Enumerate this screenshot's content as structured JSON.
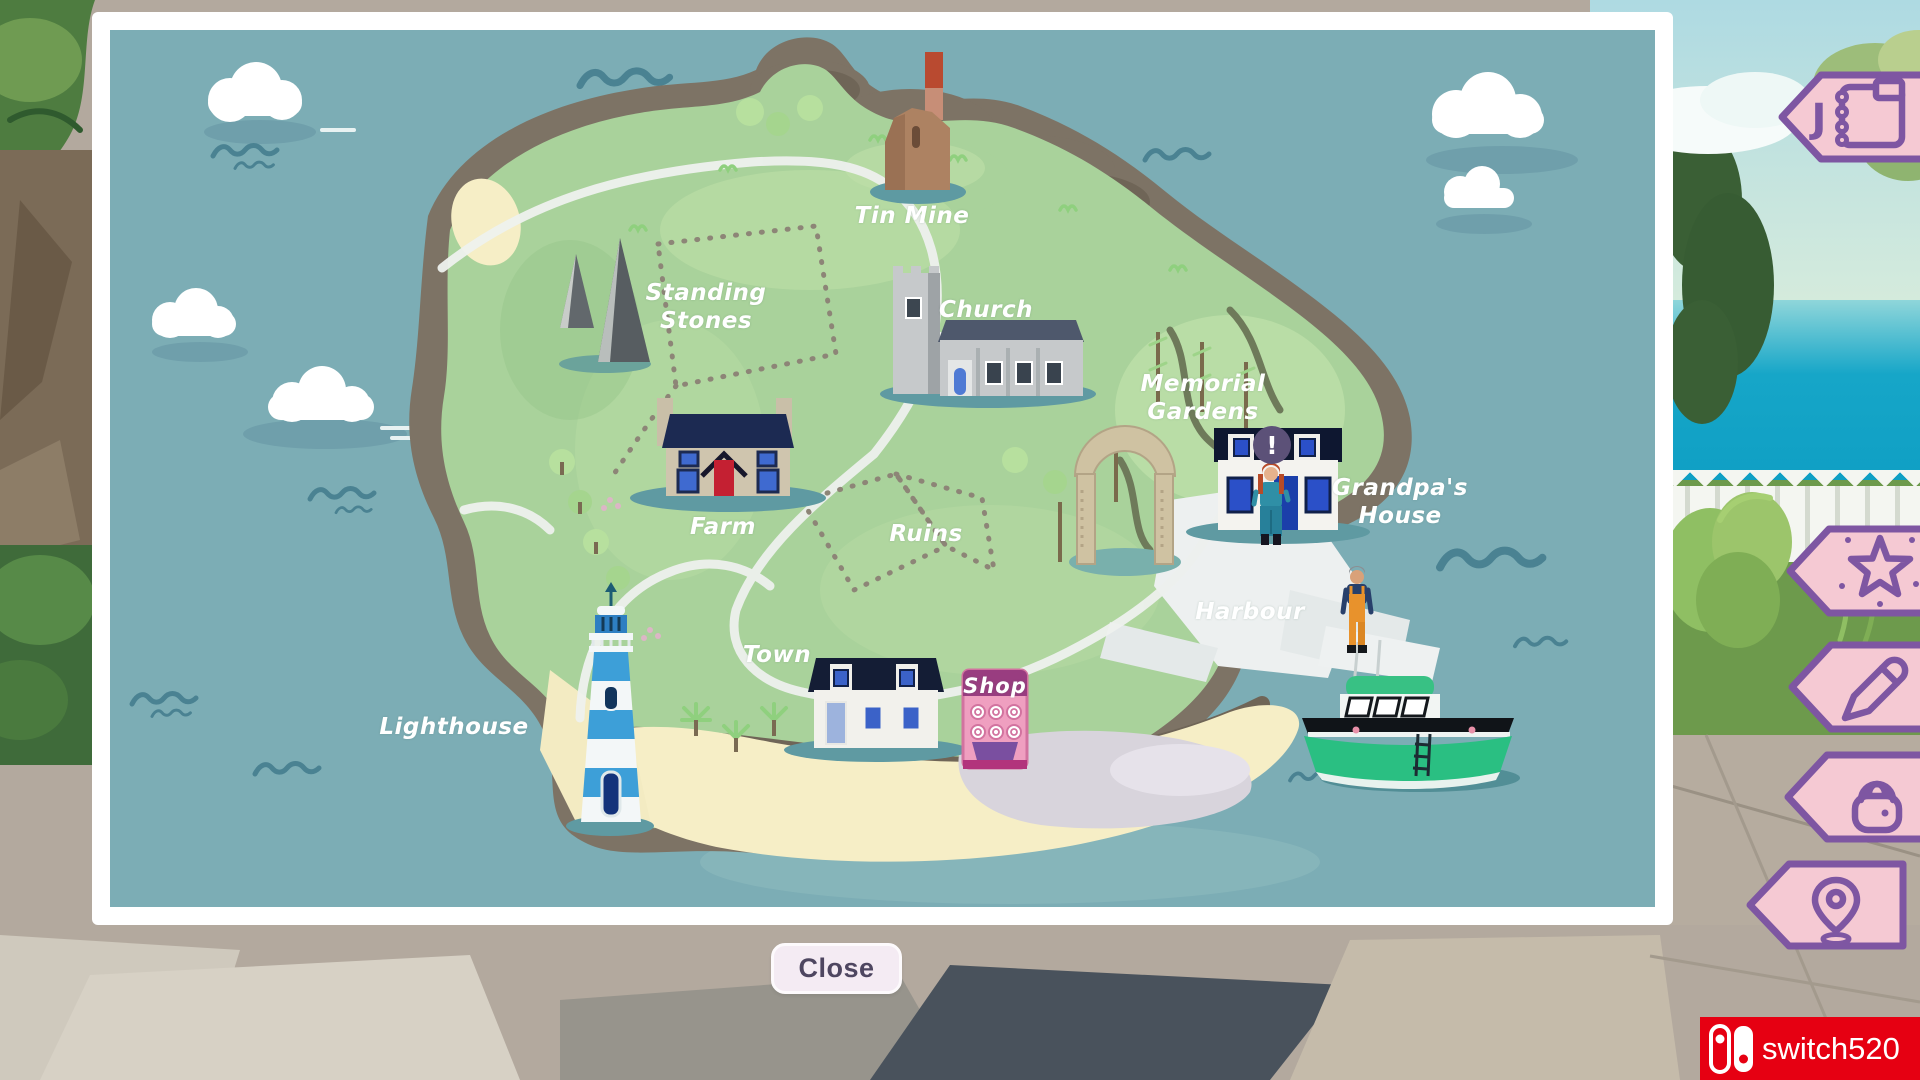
{
  "screen": {
    "name": "island-map-screen"
  },
  "map": {
    "labels": {
      "tin_mine": "Tin Mine",
      "standing_stones": "Standing Stones",
      "church": "Church",
      "memorial_gardens": "Memorial Gardens",
      "grandpas_house": "Grandpa's House",
      "farm": "Farm",
      "ruins": "Ruins",
      "harbour": "Harbour",
      "town": "Town",
      "lighthouse": "Lighthouse"
    },
    "shop_sign": "Shop",
    "alert_marker": "!",
    "close_button": "Close"
  },
  "hud": {
    "journal_hotkey": "J",
    "accent_color": "#7e56a2",
    "buttons": [
      {
        "id": "journal",
        "icon": "journal-icon",
        "fill": "#f5c9d3"
      },
      {
        "id": "achievements",
        "icon": "star-icon",
        "fill": "#f5c9d3"
      },
      {
        "id": "edit",
        "icon": "pencil-icon",
        "fill": "#f5c9d3"
      },
      {
        "id": "bag",
        "icon": "bag-icon",
        "fill": "#bccdf3"
      },
      {
        "id": "map-pin",
        "icon": "map-pin-icon",
        "fill": "#d9d3ec"
      }
    ]
  },
  "watermark": {
    "text": "switch520",
    "background": "#e60012"
  }
}
